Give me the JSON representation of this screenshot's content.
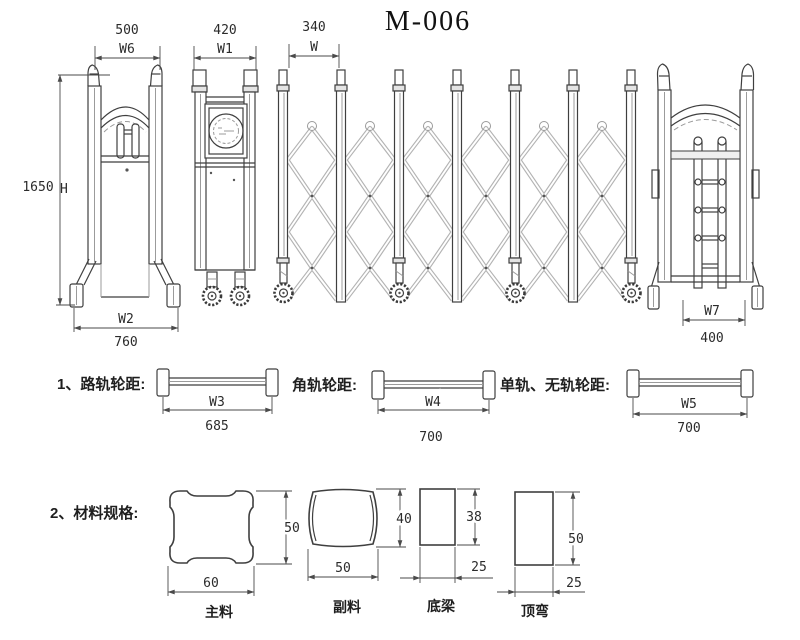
{
  "title": "M-006",
  "overview": {
    "left_pillar": {
      "top_dim_value": "500",
      "top_dim_label": "W6",
      "height_value": "1650",
      "height_label": "H",
      "base_dim_label": "W2",
      "base_dim_value": "760"
    },
    "motor_pillar": {
      "top_dim_value": "420",
      "top_dim_label": "W1"
    },
    "gate_body": {
      "pitch_value": "340",
      "pitch_label": "W"
    },
    "right_pillar": {
      "base_dim_label": "W7",
      "base_dim_value": "400"
    }
  },
  "track_section": {
    "items": [
      {
        "heading": "1、路轨轮距:",
        "dim_label": "W3",
        "dim_value": "685"
      },
      {
        "heading": "角轨轮距:",
        "dim_label": "W4",
        "dim_value": "700"
      },
      {
        "heading": "单轨、无轨轮距:",
        "dim_label": "W5",
        "dim_value": "700"
      }
    ]
  },
  "material_section": {
    "heading": "2、材料规格:",
    "items": [
      {
        "name": "主料",
        "width": "60",
        "height": "50"
      },
      {
        "name": "副料",
        "width": "50",
        "height": "40"
      },
      {
        "name": "底梁",
        "width": "25",
        "height": "38"
      },
      {
        "name": "顶弯",
        "width": "25",
        "height": "50"
      }
    ]
  },
  "colors": {
    "line": "#3f3f3f",
    "light_line": "#9b9b9b",
    "dim": "#4a4a4a",
    "text": "#2b2b2b",
    "background": "#ffffff"
  }
}
